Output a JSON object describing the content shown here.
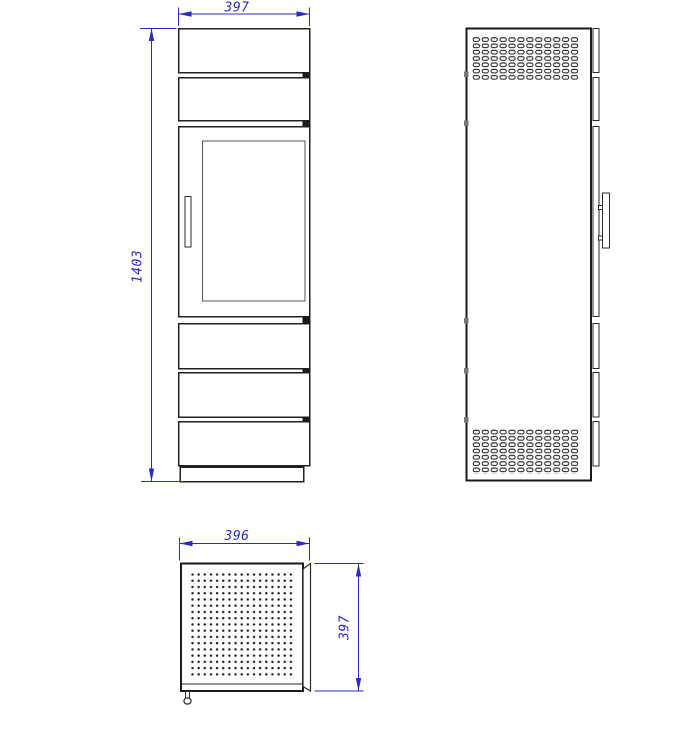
{
  "colors": {
    "background": "#ffffff",
    "drawing_line": "#1a1a1a",
    "secondary_line": "#555555",
    "dimension": "#2b2bc4"
  },
  "dimensions": {
    "front_width": "397",
    "front_height": "1403",
    "top_width": "396",
    "top_depth": "397"
  }
}
